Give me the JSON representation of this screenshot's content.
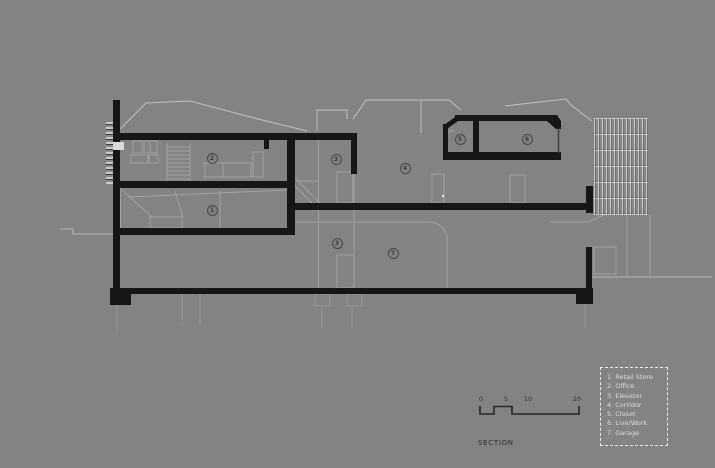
{
  "title": "SECTION",
  "colors": {
    "background": "#838383",
    "ink": "#161616",
    "roofline": "#c2c2c2",
    "detail_line": "#a2a2a2",
    "legend_text": "#dcdcdc"
  },
  "legend": {
    "items": [
      "1. Retail Store",
      "2. Office",
      "3. Elevator",
      "4. Corridor",
      "5. Closet",
      "6. Live/Work",
      "7. Garage"
    ]
  },
  "room_markers": [
    {
      "num": "1",
      "x": 212,
      "y": 210
    },
    {
      "num": "2",
      "x": 212,
      "y": 158
    },
    {
      "num": "3",
      "x": 336,
      "y": 159
    },
    {
      "num": "3",
      "x": 337,
      "y": 243
    },
    {
      "num": "4",
      "x": 405,
      "y": 168
    },
    {
      "num": "5",
      "x": 460,
      "y": 139
    },
    {
      "num": "6",
      "x": 527,
      "y": 139
    },
    {
      "num": "7",
      "x": 393,
      "y": 253
    }
  ],
  "scale_bar": {
    "labels": [
      {
        "text": "0",
        "x": 481
      },
      {
        "text": "5",
        "x": 506
      },
      {
        "text": "10",
        "x": 528
      },
      {
        "text": "20",
        "x": 577
      }
    ]
  }
}
